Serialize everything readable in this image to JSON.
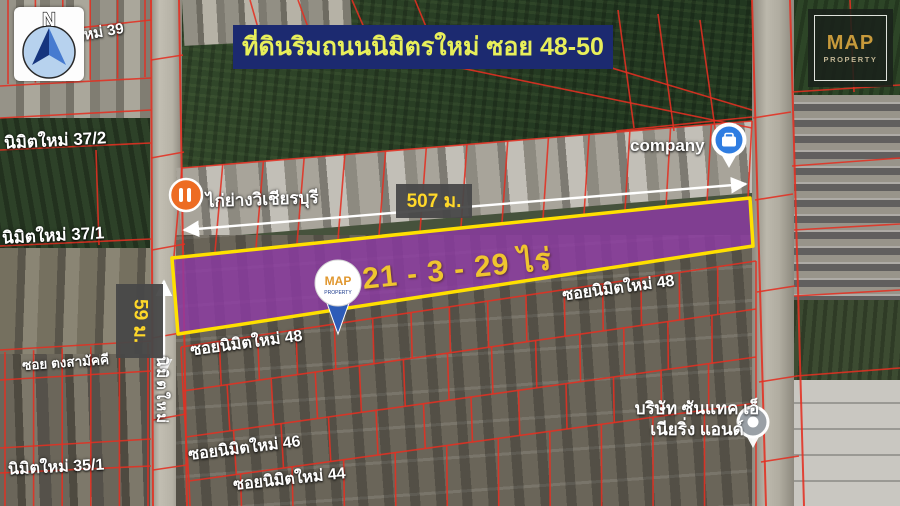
{
  "banner": {
    "text": "ที่ดินริมถนนนิมิตรใหม่ ซอย 48-50"
  },
  "compass": {
    "letter": "N"
  },
  "logo": {
    "name": "MAP",
    "subtitle": "PROPERTY"
  },
  "pin": {
    "name": "MAP",
    "subtitle": "PROPERTY"
  },
  "measurements": {
    "width": "507 ม.",
    "depth": "59 ม.",
    "area": "21 - 3 - 29 ไร่"
  },
  "map_labels": {
    "company": "company",
    "restaurant": "ไก่ย่างวิเชียรบุรี",
    "soi_39_partial": "ใหม่ 39",
    "nimit_37_2": "นิมิตใหม่ 37/2",
    "nimit_37_1": "นิมิตใหม่ 37/1",
    "soi_nimit_48": "ซอยนิมิตใหม่ 48",
    "soi_tong_samakkee": "ซอย ตงสามัคคี",
    "nimit_mai_road": "นิมิตใหม่",
    "soi_nimit_46": "ซอยนิมิตใหม่ 46",
    "soi_nimit_44": "ซอยนิมิตใหม่ 44",
    "nimit_35_1": "นิมิตใหม่ 35/1",
    "firm_line1": "บริษัท ซันแทค เอ็",
    "firm_line2": "เนียริ่ง แอนด์"
  },
  "colors": {
    "banner_bg": "#1c2a70",
    "banner_text": "#e8ef5a",
    "parcel_fill": "#8e3aa6",
    "parcel_outline": "#ffe000",
    "cadastral_line": "#e43022",
    "measurement_text": "#ffd829",
    "area_text": "#efc52f",
    "pin_blue": "#2d5cb8",
    "company_pin_blue": "#2f7de1",
    "restaurant_orange": "#ed6c23",
    "logo_gold": "#c79a3b"
  }
}
